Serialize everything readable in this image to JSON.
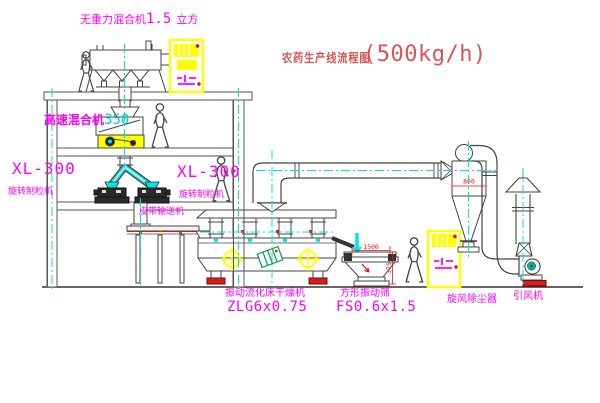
{
  "title": {
    "text": "农药生产线流程图",
    "capacity": "(500kg/h)"
  },
  "equipment_labels": {
    "gravity_mixer": {
      "name": "无重力混合机",
      "value": "1.5",
      "unit": "立方"
    },
    "high_speed_mixer": {
      "name": "高速混合机",
      "value": "350"
    },
    "granulator_left": {
      "model": "XL-300",
      "name": "旋转制粒机"
    },
    "granulator_mid": {
      "model": "XL-300",
      "name": "旋转制粒机"
    },
    "belt_conveyor": "皮带输送机",
    "fluid_bed_dryer": {
      "name": "振动流化床干燥机",
      "model": "ZLG6x0.75"
    },
    "vibrating_sieve": {
      "name": "方形振动筛",
      "model": "FS0.6x1.5"
    },
    "cyclone": "旋风除尘器",
    "induced_draft_fan": "引风机"
  },
  "dimensions": {
    "sieve_length": "1500",
    "sieve_height": "375",
    "cyclone_diameter": "800"
  },
  "colors": {
    "label_magenta": "#ff00ff",
    "title_red": "#d95555",
    "dimension_red": "#ee1111",
    "centerline_cyan": "#00e0e0",
    "equipment_yellow": "#ffff00",
    "line_dark": "#444444"
  }
}
